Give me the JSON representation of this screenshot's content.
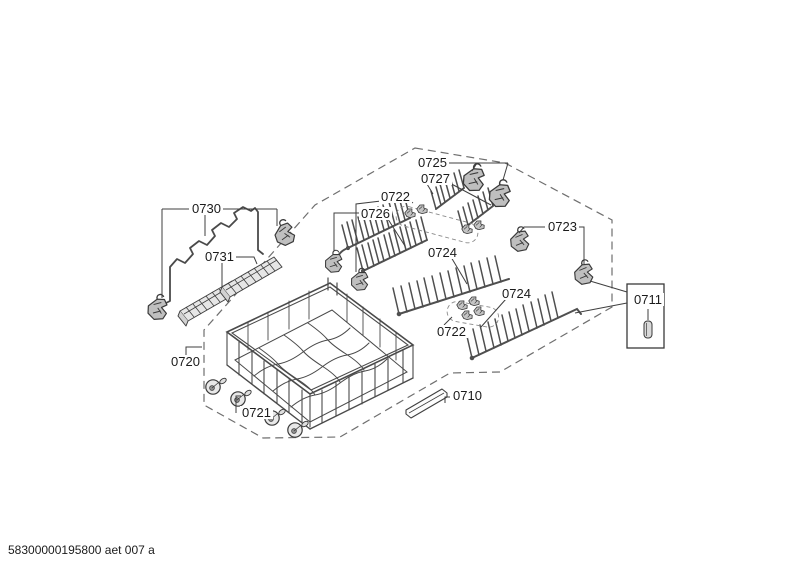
{
  "diagram": {
    "type": "exploded-parts-diagram",
    "subject": "dishwasher bottom basket assembly",
    "footer_code": "58300000195800 aet 007 a",
    "part_labels": [
      "0730",
      "0731",
      "0720",
      "0721",
      "0726",
      "0722",
      "0725",
      "0727",
      "0724",
      "0723",
      "0724",
      "0722",
      "0710",
      "0711"
    ],
    "colors": {
      "background": "#ffffff",
      "line": "#3f3f3f",
      "dashed_outline": "#6f6f6f",
      "part_fill": "#c2c2c2"
    }
  }
}
